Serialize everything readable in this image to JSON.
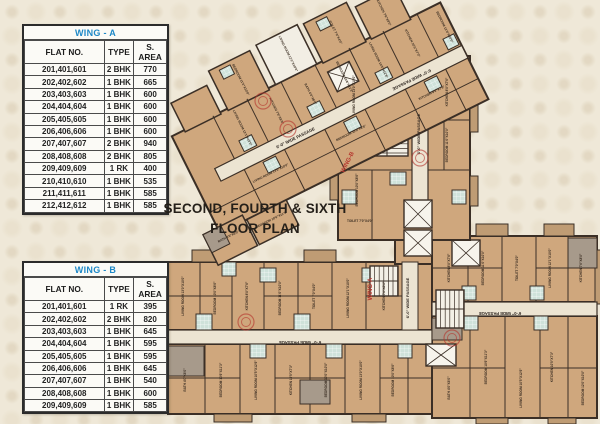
{
  "title": {
    "line1": "SECOND, FOURTH & SIXTH",
    "line2": "FLOOR PLAN"
  },
  "tables": [
    {
      "name": "WING - A",
      "columns": [
        "FLAT NO.",
        "TYPE",
        "S. AREA"
      ],
      "rows": [
        [
          "201,401,601",
          "2 BHK",
          "770"
        ],
        [
          "202,402,602",
          "1 BHK",
          "665"
        ],
        [
          "203,403,603",
          "1 BHK",
          "600"
        ],
        [
          "204,404,604",
          "1 BHK",
          "600"
        ],
        [
          "205,405,605",
          "1 BHK",
          "600"
        ],
        [
          "206,406,606",
          "1 BHK",
          "600"
        ],
        [
          "207,407,607",
          "2 BHK",
          "940"
        ],
        [
          "208,408,608",
          "2 BHK",
          "805"
        ],
        [
          "209,409,609",
          "1 RK",
          "400"
        ],
        [
          "210,410,610",
          "1 BHK",
          "535"
        ],
        [
          "211,411,611",
          "1 BHK",
          "585"
        ],
        [
          "212,412,612",
          "1 BHK",
          "585"
        ]
      ]
    },
    {
      "name": "WING - B",
      "columns": [
        "FLAT NO.",
        "TYPE",
        "S. AREA"
      ],
      "rows": [
        [
          "201,401,601",
          "1 RK",
          "395"
        ],
        [
          "202,402,602",
          "2 BHK",
          "820"
        ],
        [
          "203,403,603",
          "1 BHK",
          "645"
        ],
        [
          "204,404,604",
          "1 BHK",
          "595"
        ],
        [
          "205,405,605",
          "1 BHK",
          "595"
        ],
        [
          "206,406,606",
          "1 BHK",
          "645"
        ],
        [
          "207,407,607",
          "1 BHK",
          "540"
        ],
        [
          "208,408,608",
          "1 BHK",
          "600"
        ],
        [
          "209,409,609",
          "1 BHK",
          "585"
        ]
      ]
    }
  ],
  "plan": {
    "wing_a_label": "WING-A",
    "wing_b_label": "WING-B",
    "passage_label": "6'-0\" WIDE PASSAGE",
    "room_labels": [
      "LIVING ROOM 13'0\"X10'0\"",
      "BEDROOM 10'0\"X8'6\"",
      "KITCHEN 8'0\"X7'6\"",
      "BEDROOM 11'0\"X10'0\"",
      "TOILET 7'0\"X4'0\"",
      "LIVING ROOM 12'1\"X10'0\"",
      "KITCHEN 7'6\"X8'0\"",
      "BATH 4'0\"X6'0\"",
      "BEDROOM 10'6\"X11'3\"",
      "LIVING ROOM 10'5\"X12'6\"",
      "KITCHEN 10'5\"X7'3\"",
      "BEDROOM 12'0\"X10'0\""
    ],
    "colors": {
      "room_tan": "#cfa77d",
      "bath_teal": "#cfe2da",
      "wall_dark": "#3b2f26",
      "passage_light": "#ece4d2",
      "gray_floor": "#a79a8b",
      "stamp_red": "#b5342c",
      "table_header_blue": "#1e88c7"
    }
  }
}
